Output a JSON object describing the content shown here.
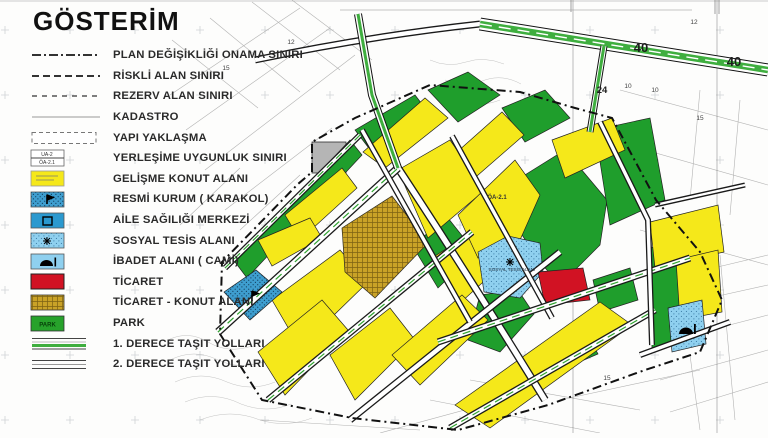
{
  "legend": {
    "title": "GÖSTERİM",
    "items": [
      {
        "label": "PLAN DEĞİŞİKLİĞİ ONAMA SINIRI",
        "symbol": "dashdot"
      },
      {
        "label": "RİSKLİ ALAN SINIRI",
        "symbol": "dashed"
      },
      {
        "label": "REZERV ALAN SINIRI",
        "symbol": "dashed2"
      },
      {
        "label": "KADASTRO",
        "symbol": "thinline"
      },
      {
        "label": "YAPI YAKLAŞMA",
        "symbol": "dashedbox"
      },
      {
        "label": "YERLEŞİME UYGUNLUK SINIRI",
        "symbol": "uabox",
        "top_text": "UA-2",
        "bottom_text": "ÖA-2.1"
      },
      {
        "label": "GELİŞME KONUT ALANI",
        "symbol": "yellowbox"
      },
      {
        "label": "RESMİ KURUM ( KARAKOL)",
        "symbol": "karakolbox"
      },
      {
        "label": "AİLE SAĞILIĞI MERKEZİ",
        "symbol": "ailebox"
      },
      {
        "label": "SOSYAL TESİS ALANI",
        "symbol": "sosyalbox"
      },
      {
        "label": "İBADET ALANI ( CAMİ)",
        "symbol": "mosquebox"
      },
      {
        "label": "TİCARET",
        "symbol": "redbox"
      },
      {
        "label": "TİCARET - KONUT ALANI",
        "symbol": "goldbox"
      },
      {
        "label": "PARK",
        "symbol": "parkbox",
        "box_text": "PARK"
      },
      {
        "label": "1. DERECE TAŞIT YOLLARI",
        "symbol": "road1"
      },
      {
        "label": "2. DERECE TAŞIT YOLLARI",
        "symbol": "road2"
      }
    ]
  },
  "map": {
    "colors": {
      "yellow": "#f5e81a",
      "green": "#1f9e2c",
      "gold": "#c9a227",
      "lblue": "#8fd0ef",
      "mblue": "#3e9ecf",
      "red": "#d11223",
      "gray": "#b5b5b5",
      "roadGreen": "#3fae3f"
    },
    "zones": [
      {
        "fill": "gray",
        "points": "312,142 346,142 346,173 312,173"
      },
      {
        "fill": "green",
        "points": "355,130 415,95 428,112 368,147"
      },
      {
        "fill": "green",
        "points": "428,90 468,72 500,95 458,122"
      },
      {
        "fill": "green",
        "points": "502,108 545,90 570,118 525,142"
      },
      {
        "fill": "green",
        "points": "520,178 565,150 607,200 600,245 560,285 540,262 522,235"
      },
      {
        "fill": "green",
        "points": "480,295 518,290 534,314 500,352 468,340"
      },
      {
        "fill": "green",
        "points": "650,248 680,240 682,345 652,348"
      },
      {
        "fill": "green",
        "points": "595,130 650,118 665,200 610,225"
      },
      {
        "fill": "green",
        "points": "235,262 350,140 362,155 247,278"
      },
      {
        "fill": "green",
        "points": "412,245 448,218 475,252 438,288"
      },
      {
        "fill": "green",
        "points": "593,280 630,268 638,300 600,312"
      },
      {
        "fill": "green",
        "points": "545,355 588,336 598,354 556,372"
      },
      {
        "fill": "yellow",
        "points": "363,152 425,98 448,118 385,168"
      },
      {
        "fill": "yellow",
        "points": "448,160 502,112 524,135 470,182"
      },
      {
        "fill": "yellow",
        "points": "398,170 450,140 485,190 428,238"
      },
      {
        "fill": "yellow",
        "points": "285,215 342,168 357,188 300,240"
      },
      {
        "fill": "yellow",
        "points": "258,240 310,218 322,238 272,266"
      },
      {
        "fill": "yellow",
        "points": "272,300 340,250 368,282 300,348"
      },
      {
        "fill": "yellow",
        "points": "258,352 322,300 348,330 285,395"
      },
      {
        "fill": "yellow",
        "points": "330,355 390,308 415,340 355,400"
      },
      {
        "fill": "yellow",
        "points": "432,258 478,228 505,262 458,305"
      },
      {
        "fill": "yellow",
        "points": "458,215 515,160 540,195 520,240 478,258"
      },
      {
        "fill": "yellow",
        "points": "552,140 612,118 625,150 565,178"
      },
      {
        "fill": "yellow",
        "points": "650,222 718,205 724,252 655,268"
      },
      {
        "fill": "yellow",
        "points": "676,260 718,250 722,312 680,320"
      },
      {
        "fill": "yellow",
        "points": "455,405 600,302 632,325 490,428"
      },
      {
        "fill": "yellow",
        "points": "392,355 462,295 488,320 420,385"
      },
      {
        "fill": "gold",
        "points": "342,228 392,196 428,243 375,298 345,272"
      },
      {
        "fill": "lblue",
        "points": "478,252 508,236 540,243 543,272 520,298 484,292"
      },
      {
        "fill": "lblue",
        "points": "668,308 702,300 706,344 672,352"
      },
      {
        "fill": "mblue",
        "points": "224,292 256,270 282,292 250,320"
      },
      {
        "fill": "red",
        "points": "538,272 583,268 590,300 545,305"
      }
    ],
    "markers": [
      {
        "type": "mosque-icon",
        "x": 686,
        "y": 330
      },
      {
        "type": "flag-icon",
        "x": 252,
        "y": 296
      },
      {
        "type": "asterisk-icon",
        "x": 510,
        "y": 262
      }
    ],
    "road_labels": [
      {
        "text": "40",
        "x": 641,
        "y": 52,
        "size": "l"
      },
      {
        "text": "40",
        "x": 734,
        "y": 66,
        "size": "l"
      },
      {
        "text": "24",
        "x": 602,
        "y": 93,
        "size": "m"
      },
      {
        "text": "12",
        "x": 291,
        "y": 44,
        "size": "s"
      },
      {
        "text": "12",
        "x": 694,
        "y": 24,
        "size": "s"
      },
      {
        "text": "15",
        "x": 226,
        "y": 70,
        "size": "s"
      },
      {
        "text": "15",
        "x": 700,
        "y": 120,
        "size": "s"
      },
      {
        "text": "15",
        "x": 607,
        "y": 380,
        "size": "s"
      },
      {
        "text": "10",
        "x": 628,
        "y": 88,
        "size": "s"
      },
      {
        "text": "10",
        "x": 655,
        "y": 92,
        "size": "s"
      }
    ],
    "zone_labels": [
      {
        "text": "ÖA-2.1",
        "x": 497,
        "y": 199,
        "cls": "zl-a"
      },
      {
        "text": "SOSYAL TESİS ALANI",
        "x": 512,
        "y": 271,
        "cls": "zl-b"
      }
    ]
  }
}
